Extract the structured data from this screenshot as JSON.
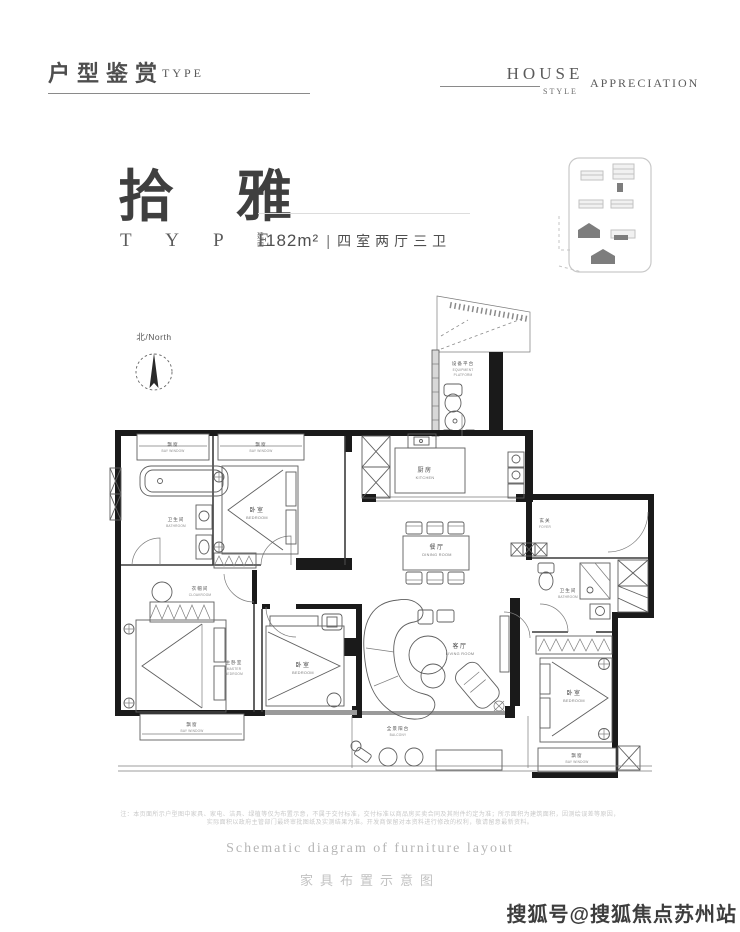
{
  "colors": {
    "ink": "#3f3f3f",
    "wall": "#1a1a1a",
    "muted": "#b9b9b9",
    "watermark": "#3d3d3d"
  },
  "header": {
    "title_cn": "户型鉴赏",
    "title_en": "TYPE",
    "right_word1": "HOUSE",
    "right_word2": "STYLE",
    "right_word3": "APPRECIATION"
  },
  "hero": {
    "name": "拾 雅",
    "name_sub": "T Y P E",
    "area_prefix_top": "建",
    "area_prefix_bottom": "面",
    "area_value": "182m²",
    "separator": "|",
    "rooms_spec": "四室两厅三卫"
  },
  "compass": {
    "label": "北/North"
  },
  "plan": {
    "rooms": [
      {
        "cn": "飘窗",
        "en": "BAY WINDOW"
      },
      {
        "cn": "飘窗",
        "en": "BAY WINDOW"
      },
      {
        "cn": "卫生间",
        "en": "BATHROOM"
      },
      {
        "cn": "卧室",
        "en": "BEDROOM"
      },
      {
        "cn": "设备平台",
        "en": "EQUIPMENT",
        "en2": "PLATFORM"
      },
      {
        "cn": "厨房",
        "en": "KITCHEN"
      },
      {
        "cn": "餐厅",
        "en": "DINING ROOM"
      },
      {
        "cn": "玄关",
        "en": "FOYER"
      },
      {
        "cn": "卫生间",
        "en": "BATHROOM"
      },
      {
        "cn": "客厅",
        "en": "LIVING ROOM"
      },
      {
        "cn": "卧室",
        "en": "BEDROOM"
      },
      {
        "cn": "主卧室",
        "en": "MASTER",
        "en2": "BEDROOM"
      },
      {
        "cn": "衣帽间",
        "en": "CLOAKROOM"
      },
      {
        "cn": "飘窗",
        "en": "BAY WINDOW"
      },
      {
        "cn": "全景阳台",
        "en": "BALCONY"
      },
      {
        "cn": "卧室",
        "en": "BEDROOM"
      },
      {
        "cn": "飘窗",
        "en": "BAY WINDOW"
      }
    ]
  },
  "captions": {
    "disclaimer_line1": "注：本页面所示户型图中家具、家电、洁具、绿植等仅为布置示意，不属于交付标准，交付标准以商品房买卖合同及其附件约定为准；所示面积为建筑面积，因测绘误差等原因，",
    "disclaimer_line2": "实际面积以政府主管部门最终审批图纸及实测结果为准。开发商保留对本资料进行修改的权利，敬请留意最新资料。",
    "caption_en": "Schematic diagram of furniture layout",
    "caption_cn": "家具布置示意图"
  },
  "watermark": {
    "text": "搜狐号@搜狐焦点苏州站"
  }
}
